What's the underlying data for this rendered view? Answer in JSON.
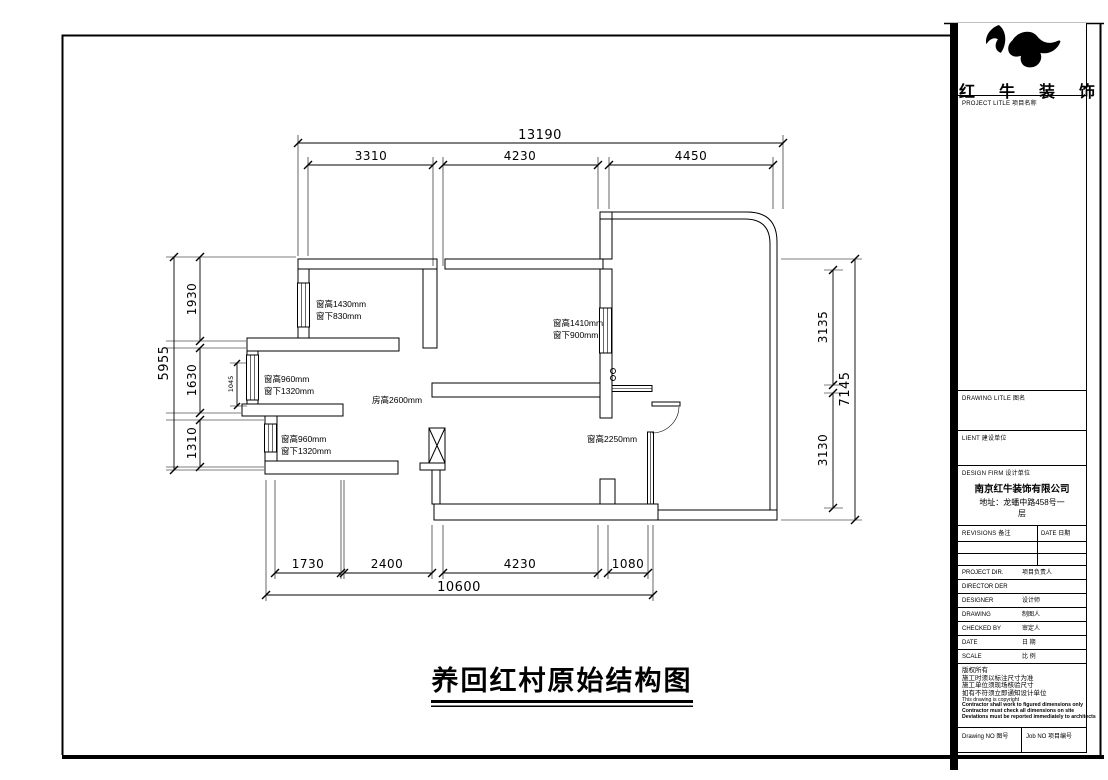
{
  "sheet": {
    "title": "养回红村原始结构图"
  },
  "brand": {
    "name": "红牛装饰"
  },
  "title_block": {
    "project_title_header": "PROJECT LITLE  项目名称",
    "drawing_title_header": "DRAWING LITLE  图名",
    "client_header": "LIENT  建设单位",
    "design_firm_header": "DESIGN FIRM  设计单位",
    "firm_name": "南京红牛装饰有限公司",
    "firm_address_line1": "地址：龙蟠中路458号一",
    "firm_address_line2": "层",
    "revisions_header": "REVISIONS  备注",
    "revisions_date_header": "DATE  日期",
    "rows": [
      {
        "label": "PROJECT DIR.",
        "value": "项目负责人"
      },
      {
        "label": "DIRECTOR DER",
        "value": ""
      },
      {
        "label": "DESIGNER",
        "value": "设计师"
      },
      {
        "label": "DRAWING",
        "value": "制图人"
      },
      {
        "label": "CHECKED BY",
        "value": "审定人"
      },
      {
        "label": "DATE",
        "value": "日 期"
      },
      {
        "label": "SCALE",
        "value": "比 例"
      }
    ],
    "notes": [
      "版权所有",
      "施工时须以标注尺寸为准",
      "施工单位须现场核验尺寸",
      "如有不符须立即通知设计单位",
      "This drawing is copyright"
    ],
    "notes_en": [
      "Contractor shall work to figured dimensions only",
      "Contractor must check all dimensions on site",
      "Deviations must be reported immediately to architects"
    ],
    "drawing_no_label": "Drawing NO  图号",
    "job_no_label": "Job NO  项目编号"
  },
  "plan": {
    "dimensions": {
      "top": {
        "total": "13190",
        "segments": [
          "3310",
          "4230",
          "4450"
        ]
      },
      "bottom": {
        "total": "10600",
        "segments": [
          "1730",
          "2400",
          "4230",
          "1080"
        ]
      },
      "left": {
        "total": "5955",
        "segments": [
          "1930",
          "1630",
          "1310"
        ],
        "inner": "1045"
      },
      "right": {
        "total": "7145",
        "segments": [
          "3135",
          "3130"
        ]
      }
    },
    "annotations": {
      "win_topleft_1": "窗高1430mm",
      "win_topleft_2": "窗下830mm",
      "win_right_1": "窗高1410mm",
      "win_right_2": "窗下900mm",
      "win_bay_upper_1": "窗高960mm",
      "win_bay_upper_2": "窗下1320mm",
      "room_height": "房高2600mm",
      "win_bay_lower_1": "窗高960mm",
      "win_bay_lower_2": "窗下1320mm",
      "win_balcony": "窗高2250mm"
    }
  }
}
